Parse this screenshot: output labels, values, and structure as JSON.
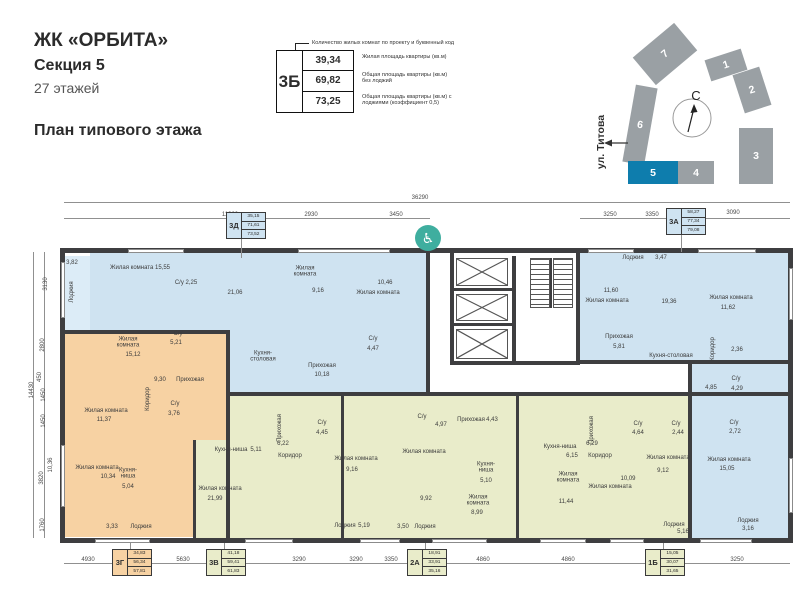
{
  "header": {
    "title": "ЖК «ОРБИТА»",
    "subtitle": "Секция 5",
    "floors": "27 этажей",
    "plan_title": "План типового этажа"
  },
  "legend": {
    "callout": "Количество жилых комнат по проекту и буквенный код",
    "code": "3Б",
    "rows": [
      {
        "value": "39,34",
        "desc": "Жилая площадь квартиры (кв.м)"
      },
      {
        "value": "69,82",
        "desc": "Общая площадь квартиры (кв.м) без лоджий"
      },
      {
        "value": "73,25",
        "desc": "Общая площадь квартиры (кв.м) с лоджиями (коэффициент 0,5)"
      }
    ]
  },
  "siteplan": {
    "north_label": "С",
    "street": "ул. Титова",
    "grey": "#9aa0a4",
    "highlight": "#0e7dad",
    "sections": [
      {
        "label": "7",
        "x": 638,
        "y": 36,
        "w": 54,
        "h": 36,
        "rot": -40
      },
      {
        "label": "6",
        "x": 629,
        "y": 86,
        "w": 22,
        "h": 78,
        "rot": 10
      },
      {
        "label": "1",
        "x": 707,
        "y": 54,
        "w": 38,
        "h": 22,
        "rot": -18
      },
      {
        "label": "2",
        "x": 738,
        "y": 70,
        "w": 28,
        "h": 40,
        "rot": -18
      },
      {
        "label": "3",
        "x": 739,
        "y": 128,
        "w": 34,
        "h": 56,
        "rot": 0
      },
      {
        "label": "5",
        "x": 628,
        "y": 161,
        "w": 50,
        "h": 23,
        "rot": 0,
        "hl": true
      },
      {
        "label": "4",
        "x": 678,
        "y": 161,
        "w": 36,
        "h": 23,
        "rot": 0
      }
    ]
  },
  "floorplan": {
    "colors": {
      "wall": "#3e3e40",
      "blue": "#cfe3f1",
      "blueL": "#dcecf7",
      "orange": "#f7d2a3",
      "green": "#e9ecca",
      "teal": "#3fae9f"
    },
    "accessibility_icon": {
      "x": 428,
      "y": 238
    },
    "regions": [
      [
        90,
        252,
        338,
        80,
        "blue"
      ],
      [
        230,
        332,
        198,
        62,
        "blue"
      ],
      [
        62,
        256,
        28,
        76,
        "blueL"
      ],
      [
        578,
        252,
        215,
        110,
        "blue"
      ],
      [
        690,
        362,
        103,
        176,
        "blue"
      ],
      [
        64,
        332,
        164,
        108,
        "orange"
      ],
      [
        64,
        440,
        131,
        97,
        "orange"
      ],
      [
        195,
        440,
        33,
        98,
        "green"
      ],
      [
        228,
        394,
        462,
        144,
        "green"
      ]
    ],
    "walls": [
      [
        60,
        248,
        733,
        5
      ],
      [
        60,
        538,
        733,
        5
      ],
      [
        60,
        248,
        5,
        295
      ],
      [
        788,
        248,
        5,
        295
      ],
      [
        426,
        252,
        4,
        144
      ],
      [
        576,
        252,
        4,
        112
      ],
      [
        450,
        252,
        4,
        112
      ],
      [
        512,
        256,
        4,
        108
      ],
      [
        450,
        361,
        130,
        4
      ],
      [
        454,
        288,
        58,
        3
      ],
      [
        454,
        323,
        58,
        3
      ],
      [
        226,
        330,
        4,
        208
      ],
      [
        60,
        330,
        170,
        4
      ],
      [
        228,
        392,
        562,
        4
      ],
      [
        576,
        360,
        214,
        4
      ],
      [
        426,
        362,
        4,
        34
      ],
      [
        341,
        394,
        3,
        144
      ],
      [
        516,
        394,
        3,
        144
      ],
      [
        688,
        360,
        4,
        178
      ],
      [
        193,
        440,
        3,
        98
      ]
    ],
    "windows": [
      [
        128,
        249,
        56,
        4
      ],
      [
        298,
        249,
        92,
        4
      ],
      [
        588,
        249,
        46,
        4
      ],
      [
        698,
        249,
        58,
        4
      ],
      [
        95,
        539,
        55,
        4
      ],
      [
        245,
        539,
        48,
        4
      ],
      [
        360,
        539,
        40,
        4
      ],
      [
        432,
        539,
        55,
        4
      ],
      [
        540,
        539,
        46,
        4
      ],
      [
        610,
        539,
        34,
        4
      ],
      [
        700,
        539,
        52,
        4
      ],
      [
        61,
        262,
        4,
        56
      ],
      [
        61,
        445,
        4,
        62
      ],
      [
        789,
        268,
        4,
        52
      ],
      [
        789,
        458,
        4,
        55
      ]
    ],
    "lines": [
      [
        64,
        202,
        726,
        1
      ],
      [
        64,
        218,
        366,
        1
      ],
      [
        580,
        218,
        210,
        1
      ],
      [
        64,
        563,
        726,
        1
      ],
      [
        44,
        252,
        1,
        286
      ],
      [
        33,
        252,
        1,
        286
      ],
      [
        241,
        239,
        1,
        19
      ],
      [
        681,
        235,
        1,
        17
      ],
      [
        130,
        543,
        1,
        6
      ],
      [
        224,
        543,
        1,
        6
      ],
      [
        425,
        543,
        1,
        6
      ],
      [
        663,
        543,
        1,
        6
      ]
    ],
    "elevators": [
      [
        456,
        258,
        52,
        28
      ],
      [
        456,
        294,
        52,
        27
      ],
      [
        456,
        329,
        52,
        30
      ]
    ],
    "stairs": {
      "cols": [
        [
          530,
          258,
          20,
          50
        ],
        [
          553,
          258,
          20,
          50
        ]
      ],
      "divider": [
        550,
        258,
        2,
        50
      ]
    },
    "tags": [
      {
        "code": "3Д",
        "vals": [
          "35,15",
          "71,61",
          "73,52"
        ],
        "x": 226,
        "y": 212,
        "fill": "blue"
      },
      {
        "code": "3А",
        "vals": [
          "58,27",
          "77,34",
          "79,08"
        ],
        "x": 666,
        "y": 208,
        "fill": "blue"
      },
      {
        "code": "3Г",
        "vals": [
          "34,83",
          "56,34",
          "57,81"
        ],
        "x": 112,
        "y": 549,
        "fill": "orange"
      },
      {
        "code": "3В",
        "vals": [
          "41,18",
          "59,41",
          "61,83"
        ],
        "x": 206,
        "y": 549,
        "fill": "green"
      },
      {
        "code": "2А",
        "vals": [
          "18,91",
          "33,91",
          "35,16"
        ],
        "x": 407,
        "y": 549,
        "fill": "green"
      },
      {
        "code": "1Б",
        "vals": [
          "15,05",
          "30,07",
          "31,65"
        ],
        "x": 645,
        "y": 549,
        "fill": "green"
      }
    ],
    "texts": [
      {
        "t": "3,82",
        "x": 72,
        "y": 263
      },
      {
        "t": "Лоджия",
        "x": 72,
        "y": 292,
        "r": -90
      },
      {
        "t": "Жилая комната  15,55",
        "x": 140,
        "y": 268
      },
      {
        "t": "С/у  2,25",
        "x": 186,
        "y": 283
      },
      {
        "t": "21,06",
        "x": 235,
        "y": 293
      },
      {
        "t": "Кухня-столовая",
        "x": 263,
        "y": 357,
        "w": 36
      },
      {
        "t": "Жилая комната",
        "x": 305,
        "y": 272,
        "w": 32
      },
      {
        "t": "9,16",
        "x": 318,
        "y": 291
      },
      {
        "t": "10,46",
        "x": 385,
        "y": 283
      },
      {
        "t": "Жилая комната",
        "x": 378,
        "y": 293
      },
      {
        "t": "Прихожая",
        "x": 322,
        "y": 366
      },
      {
        "t": "10,18",
        "x": 322,
        "y": 375
      },
      {
        "t": "С/у",
        "x": 373,
        "y": 339
      },
      {
        "t": "4,47",
        "x": 373,
        "y": 349
      },
      {
        "t": "Лоджия",
        "x": 633,
        "y": 258
      },
      {
        "t": "3,47",
        "x": 661,
        "y": 258
      },
      {
        "t": "11,60",
        "x": 611,
        "y": 291
      },
      {
        "t": "Жилая комната",
        "x": 607,
        "y": 301
      },
      {
        "t": "19,36",
        "x": 669,
        "y": 302
      },
      {
        "t": "Жилая комната",
        "x": 731,
        "y": 298
      },
      {
        "t": "11,62",
        "x": 728,
        "y": 308
      },
      {
        "t": "Прихожая",
        "x": 619,
        "y": 337
      },
      {
        "t": "5,81",
        "x": 619,
        "y": 347
      },
      {
        "t": "Кухня-столовая",
        "x": 671,
        "y": 356
      },
      {
        "t": "Коридор",
        "x": 713,
        "y": 349,
        "r": -90
      },
      {
        "t": "2,36",
        "x": 737,
        "y": 350
      },
      {
        "t": "4,85",
        "x": 711,
        "y": 388
      },
      {
        "t": "С/у",
        "x": 736,
        "y": 379
      },
      {
        "t": "4,29",
        "x": 737,
        "y": 389
      },
      {
        "t": "С/у",
        "x": 734,
        "y": 423
      },
      {
        "t": "2,72",
        "x": 735,
        "y": 432
      },
      {
        "t": "Жилая комната",
        "x": 729,
        "y": 460
      },
      {
        "t": "15,05",
        "x": 727,
        "y": 469
      },
      {
        "t": "Лоджия",
        "x": 748,
        "y": 521
      },
      {
        "t": "3,16",
        "x": 748,
        "y": 529
      },
      {
        "t": "Жилая комната",
        "x": 128,
        "y": 343,
        "w": 32
      },
      {
        "t": "15,12",
        "x": 133,
        "y": 355
      },
      {
        "t": "С/у",
        "x": 178,
        "y": 334
      },
      {
        "t": "5,21",
        "x": 176,
        "y": 343
      },
      {
        "t": "9,30",
        "x": 160,
        "y": 380
      },
      {
        "t": "Прихожая",
        "x": 190,
        "y": 380
      },
      {
        "t": "Коридор",
        "x": 148,
        "y": 399,
        "r": -90
      },
      {
        "t": "Жилая комната",
        "x": 106,
        "y": 411
      },
      {
        "t": "11,37",
        "x": 104,
        "y": 420
      },
      {
        "t": "С/у",
        "x": 175,
        "y": 404
      },
      {
        "t": "3,76",
        "x": 174,
        "y": 414
      },
      {
        "t": "Жилая комната",
        "x": 97,
        "y": 468
      },
      {
        "t": "10,34",
        "x": 108,
        "y": 477
      },
      {
        "t": "Кухня-ниша",
        "x": 128,
        "y": 474,
        "w": 26
      },
      {
        "t": "5,04",
        "x": 128,
        "y": 487
      },
      {
        "t": "3,33",
        "x": 112,
        "y": 527
      },
      {
        "t": "Лоджия",
        "x": 141,
        "y": 527
      },
      {
        "t": "Кухня-ниша",
        "x": 231,
        "y": 450
      },
      {
        "t": "5,11",
        "x": 256,
        "y": 450
      },
      {
        "t": "Жилая комната",
        "x": 220,
        "y": 489
      },
      {
        "t": "21,99",
        "x": 215,
        "y": 499
      },
      {
        "t": "Прихожая",
        "x": 280,
        "y": 428,
        "r": -90
      },
      {
        "t": "6,22",
        "x": 283,
        "y": 444
      },
      {
        "t": "Коридор",
        "x": 290,
        "y": 456
      },
      {
        "t": "С/у",
        "x": 322,
        "y": 423
      },
      {
        "t": "4,45",
        "x": 322,
        "y": 433
      },
      {
        "t": "Жилая комната",
        "x": 356,
        "y": 459
      },
      {
        "t": "9,16",
        "x": 352,
        "y": 470
      },
      {
        "t": "Лоджия",
        "x": 345,
        "y": 526
      },
      {
        "t": "5,19",
        "x": 364,
        "y": 526
      },
      {
        "t": "С/у",
        "x": 422,
        "y": 417
      },
      {
        "t": "4,97",
        "x": 441,
        "y": 425
      },
      {
        "t": "Прихожая",
        "x": 471,
        "y": 420
      },
      {
        "t": "4,43",
        "x": 492,
        "y": 420
      },
      {
        "t": "Жилая комната",
        "x": 424,
        "y": 452
      },
      {
        "t": "9,92",
        "x": 426,
        "y": 499
      },
      {
        "t": "Кухня-ниша",
        "x": 486,
        "y": 468,
        "w": 26
      },
      {
        "t": "5,10",
        "x": 486,
        "y": 481
      },
      {
        "t": "Жилая комната",
        "x": 478,
        "y": 501,
        "w": 32
      },
      {
        "t": "8,99",
        "x": 477,
        "y": 513
      },
      {
        "t": "3,50",
        "x": 403,
        "y": 527
      },
      {
        "t": "Лоджия",
        "x": 425,
        "y": 527
      },
      {
        "t": "Кухня-ниша",
        "x": 560,
        "y": 447
      },
      {
        "t": "6,15",
        "x": 572,
        "y": 456
      },
      {
        "t": "Жилая комната",
        "x": 568,
        "y": 478,
        "w": 32
      },
      {
        "t": "11,44",
        "x": 566,
        "y": 502
      },
      {
        "t": "Прихожая",
        "x": 592,
        "y": 430,
        "r": -90
      },
      {
        "t": "6,29",
        "x": 592,
        "y": 444
      },
      {
        "t": "Коридор",
        "x": 600,
        "y": 456
      },
      {
        "t": "С/у",
        "x": 638,
        "y": 424
      },
      {
        "t": "4,64",
        "x": 638,
        "y": 433
      },
      {
        "t": "С/у",
        "x": 676,
        "y": 424
      },
      {
        "t": "2,44",
        "x": 678,
        "y": 433
      },
      {
        "t": "Жилая комната",
        "x": 668,
        "y": 458
      },
      {
        "t": "9,12",
        "x": 663,
        "y": 471
      },
      {
        "t": "Жилая комната",
        "x": 610,
        "y": 487
      },
      {
        "t": "10,09",
        "x": 628,
        "y": 479
      },
      {
        "t": "Лоджия",
        "x": 674,
        "y": 525
      },
      {
        "t": "5,16",
        "x": 683,
        "y": 532
      },
      {
        "t": "36290",
        "x": 420,
        "y": 198,
        "n": "dim"
      },
      {
        "t": "11320",
        "x": 230,
        "y": 215,
        "n": "dim"
      },
      {
        "t": "2930",
        "x": 311,
        "y": 215,
        "n": "dim"
      },
      {
        "t": "3450",
        "x": 396,
        "y": 215,
        "n": "dim"
      },
      {
        "t": "3250",
        "x": 610,
        "y": 215,
        "n": "dim"
      },
      {
        "t": "3350",
        "x": 652,
        "y": 215,
        "n": "dim"
      },
      {
        "t": "3090",
        "x": 733,
        "y": 213,
        "n": "dim"
      },
      {
        "t": "4930",
        "x": 88,
        "y": 560,
        "n": "dim"
      },
      {
        "t": "5630",
        "x": 183,
        "y": 560,
        "n": "dim"
      },
      {
        "t": "3290",
        "x": 299,
        "y": 560,
        "n": "dim"
      },
      {
        "t": "3290",
        "x": 356,
        "y": 560,
        "n": "dim"
      },
      {
        "t": "3350",
        "x": 391,
        "y": 560,
        "n": "dim"
      },
      {
        "t": "4860",
        "x": 483,
        "y": 560,
        "n": "dim"
      },
      {
        "t": "4860",
        "x": 568,
        "y": 560,
        "n": "dim"
      },
      {
        "t": "3250",
        "x": 737,
        "y": 560,
        "n": "dim"
      },
      {
        "t": "3130",
        "x": 46,
        "y": 284,
        "r": -90,
        "n": "dim"
      },
      {
        "t": "2800",
        "x": 43,
        "y": 345,
        "r": -90,
        "n": "dim"
      },
      {
        "t": "450",
        "x": 40,
        "y": 377,
        "r": -90,
        "n": "dim"
      },
      {
        "t": "1450",
        "x": 44,
        "y": 395,
        "r": -90,
        "n": "dim"
      },
      {
        "t": "1450",
        "x": 44,
        "y": 421,
        "r": -90,
        "n": "dim"
      },
      {
        "t": "10,36",
        "x": 51,
        "y": 465,
        "r": -90,
        "n": "dim"
      },
      {
        "t": "3820",
        "x": 42,
        "y": 478,
        "r": -90,
        "n": "dim"
      },
      {
        "t": "1760",
        "x": 43,
        "y": 525,
        "r": -90,
        "n": "dim"
      },
      {
        "t": "14430",
        "x": 32,
        "y": 390,
        "r": -90,
        "n": "dim"
      }
    ]
  }
}
